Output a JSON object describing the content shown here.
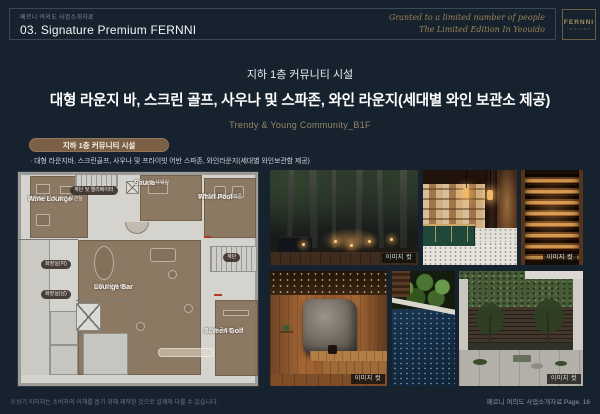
{
  "header": {
    "eyebrow": "페르니 여의도 사업소개자료",
    "title": "03. Signature Premium FERNNI",
    "tagline1": "Granted to a limited number of people",
    "tagline2": "The Limited Edition In Yeouido",
    "logo": "FERNNI",
    "logo_sub": "YEOUIDO"
  },
  "hero": {
    "eyebrow": "지하 1층 커뮤니티 시설",
    "headline": "대형 라운지 바, 스크린 골프, 사우나 및 스파존, 와인 라운지(세대별 와인 보관소 제공)",
    "tagline": "Trendy & Young Community_B1F"
  },
  "section": {
    "pill": "지하 1층 커뮤니티 시설",
    "bullet": "· 대형 라운지바, 스크린골프, 사우나 및 프라이빗 어반 스파존, 와인라운지(세대별 와인보관함 제공)"
  },
  "floorplan": {
    "rooms": [
      {
        "en": "Wine Lounge",
        "ko": "와인라운지 및 와인 보관실"
      },
      {
        "en": "Sauna",
        "ko": "사우나 및 샤워실"
      },
      {
        "en": "Whirl Pool",
        "ko": "프라이빗 어반 스파존"
      },
      {
        "en": "Lounge Bar",
        "ko": "대형 라운지 바"
      },
      {
        "en": "Screen Golf",
        "ko": "스크린 골프장"
      }
    ],
    "pills": {
      "elevator": "계단 및 엘리베이터",
      "wc_women": "화장실(여)",
      "wc_men": "화장실(남)",
      "stair": "계단"
    }
  },
  "photos": {
    "caption": "이미지 컷"
  },
  "footer": {
    "disclaimer": "※상기 이미지는 소비자의 이해를 돕기 위해 제작된 것으로 실제와 다를 수 있습니다.",
    "page": "페르니 여의도 사업소개자료 Page. 16"
  },
  "colors": {
    "background": "#16222d",
    "gold": "#a18653",
    "plan_highlight": "#86715a",
    "pill_brown": "#7c6045"
  }
}
